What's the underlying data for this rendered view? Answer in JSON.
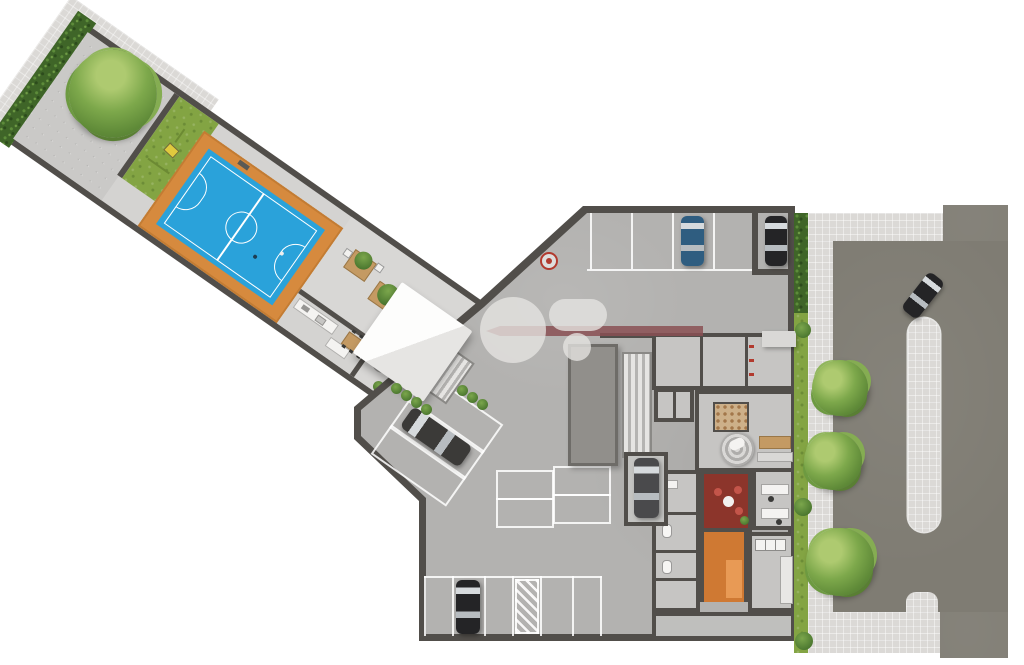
{
  "meta": {
    "kind": "architectural-ground-floor-site-plan",
    "text_visible": false
  },
  "palette": {
    "page_bg": "#ffffff",
    "wall_dark": "#514e4a",
    "wing_floor": "#d4d3d1",
    "patio_paver": "#cac9c7",
    "sidewalk": "#dbd9d6",
    "hedge_green": "#3f6528",
    "lawn_green": "#83a443",
    "deck_orange": "#d68a3e",
    "court_blue": "#2aa2da",
    "court_line": "#ffffff",
    "garage_floor": "#b3b2b0",
    "room_floor": "#c6c5c3",
    "asphalt": "#7f7c73",
    "median": "#d6d5d2",
    "lounge_red": "#8c352b",
    "corridor_orange": "#cf7933",
    "wood": "#c49a63",
    "plant_green": "#5e8f3c",
    "toy_yellow": "#e0c93e",
    "marker_red": "#b23a2e",
    "car_blue": "#2f5d80",
    "car_black": "#242426",
    "car_dark": "#3b3a38",
    "car_silver": "#4a4a4c",
    "watermark_gray": "rgba(230,228,225,0.78)",
    "watermark_red": "rgba(138,80,84,0.85)"
  },
  "inventory": {
    "leisure_wing": [
      "perimeter-hedge",
      "outer-sidewalk",
      "paved-patio",
      "large-tree",
      "play-lawn",
      "play-toy",
      "sports-court-deck",
      "futsal-court",
      "court-markings",
      "balls",
      "planter-tables",
      "round-planters",
      "bbq-kitchen",
      "kitchen-counter",
      "kitchen-island",
      "dining-table",
      "entry-canopy",
      "entry-stairs",
      "shrub-rows"
    ],
    "garage": [
      "top-parking-row",
      "parking-alcove",
      "floor-marker-target",
      "diagonal-parking-pocket",
      "middle-parking-cluster",
      "bottom-parking-row",
      "no-parking-hatch",
      "ramp-slab",
      "stairwell",
      "elevator-bank",
      "service-rooms",
      "mail-room",
      "round-lobby-rug",
      "reception-desk",
      "lounge-room",
      "orange-corridor",
      "laundry-room",
      "office-room",
      "bathrooms",
      "boxed-garage"
    ],
    "street_side": [
      "hedge-strip",
      "grass-strip",
      "sidewalk",
      "driveway",
      "median-island",
      "median-stub",
      "street-trees",
      "entry-canopy-roof"
    ],
    "cars": {
      "count": 6,
      "colors": [
        "car_blue",
        "car_black",
        "car_dark",
        "car_silver",
        "car_dark",
        "car_black"
      ]
    },
    "trees": {
      "count": 4
    },
    "watermark": {
      "shapes": [
        "big-circle",
        "rounded-rect",
        "small-dot",
        "arrow-bar"
      ]
    }
  }
}
